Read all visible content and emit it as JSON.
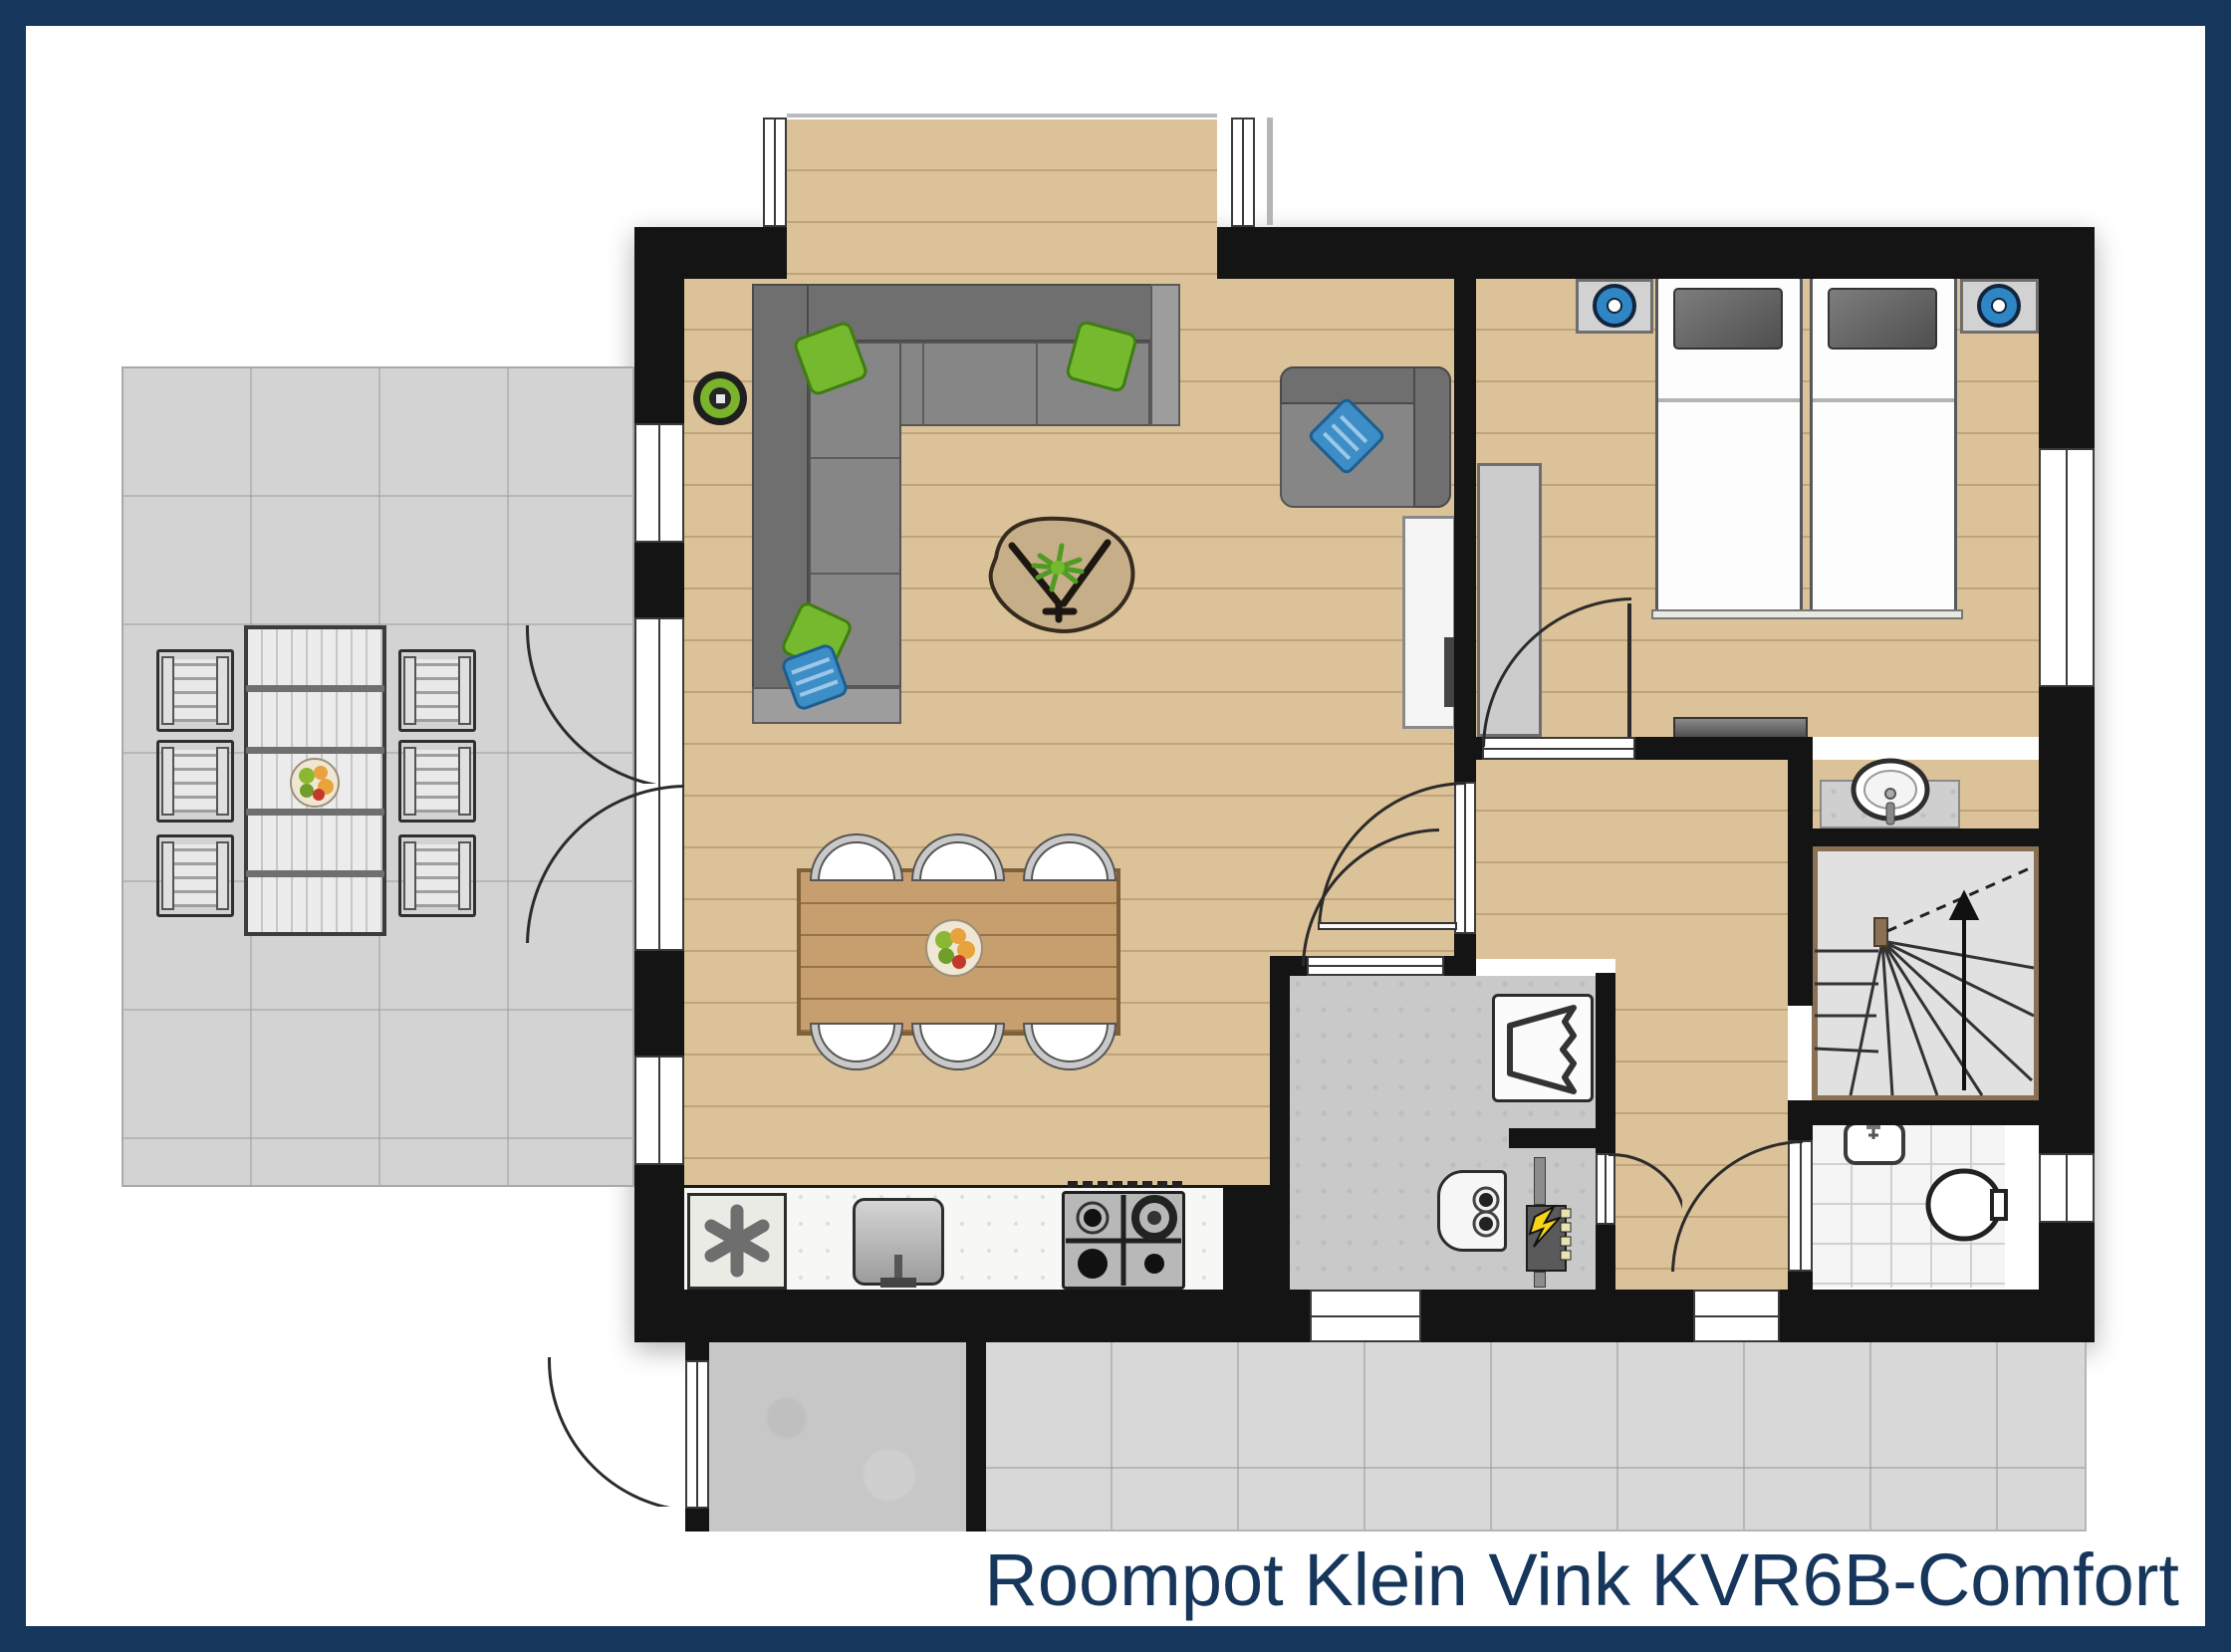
{
  "title": {
    "text": "Roompot Klein Vink KVR6B-Comfort",
    "color": "#16365c"
  },
  "colors": {
    "frame_navy": "#16365c",
    "wall_black": "#141414",
    "wood_floor": "#dbc298",
    "terrace_gray": "#d3d3d3",
    "accent_green": "#74b92e",
    "accent_blue": "#3d8ec6",
    "bolt_yellow": "#f7d417"
  },
  "rooms": [
    {
      "name": "terrace"
    },
    {
      "name": "living-room"
    },
    {
      "name": "dining-area"
    },
    {
      "name": "kitchen"
    },
    {
      "name": "bedroom"
    },
    {
      "name": "hallway"
    },
    {
      "name": "utility-room"
    },
    {
      "name": "meter-cupboard"
    },
    {
      "name": "staircase"
    },
    {
      "name": "toilet"
    },
    {
      "name": "washbasin-niche"
    },
    {
      "name": "entry-porch"
    },
    {
      "name": "patio"
    }
  ],
  "furniture": [
    {
      "name": "corner-sofa"
    },
    {
      "name": "armchair"
    },
    {
      "name": "coffee-table"
    },
    {
      "name": "dining-table"
    },
    {
      "name": "dining-chairs",
      "count": 6
    },
    {
      "name": "outdoor-table"
    },
    {
      "name": "outdoor-chairs",
      "count": 6
    },
    {
      "name": "twin-beds",
      "count": 2
    },
    {
      "name": "nightstands",
      "count": 2
    },
    {
      "name": "wardrobe"
    },
    {
      "name": "tv-sideboard"
    },
    {
      "name": "bedroom-tv-shelf"
    },
    {
      "name": "freezer"
    },
    {
      "name": "kitchen-sink"
    },
    {
      "name": "gas-hob"
    },
    {
      "name": "washing-machine"
    },
    {
      "name": "boiler"
    },
    {
      "name": "fuse-box"
    },
    {
      "name": "toilet-bowl"
    },
    {
      "name": "toilet-hand-basin"
    },
    {
      "name": "washbasin"
    },
    {
      "name": "robot-vacuum"
    }
  ],
  "icons": [
    {
      "name": "freezer-icon",
      "meaning": "frost asterisk"
    },
    {
      "name": "electricity-icon",
      "meaning": "lightning bolt"
    },
    {
      "name": "stairs-up-arrow-icon",
      "meaning": "stair direction up"
    }
  ]
}
